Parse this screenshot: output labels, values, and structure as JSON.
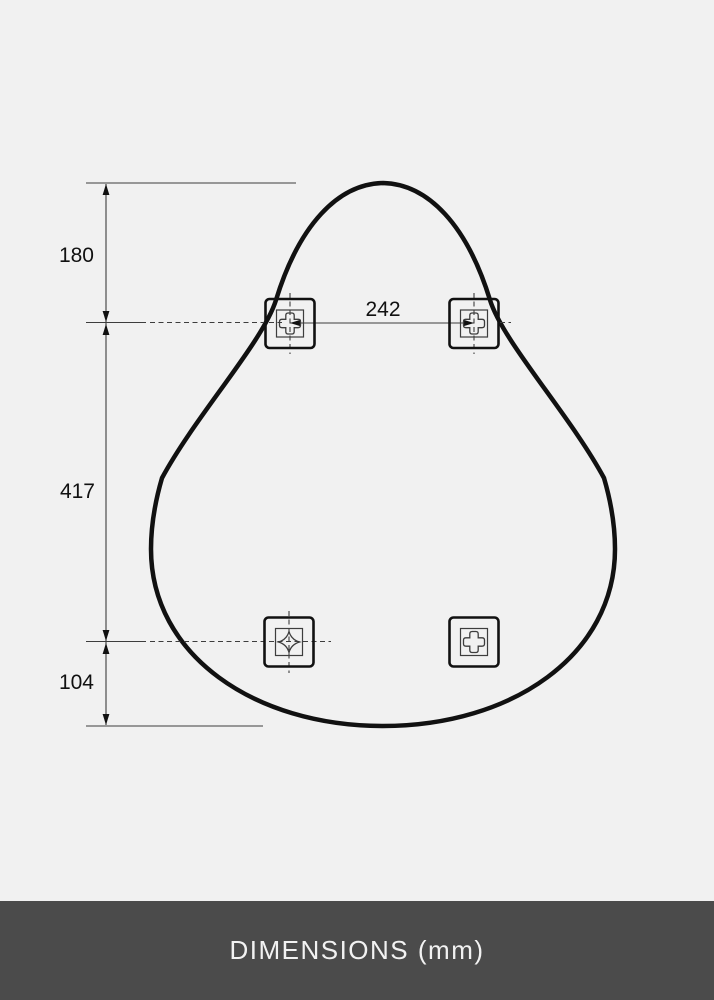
{
  "colors": {
    "bg": "#f1f1f1",
    "ink": "#111111",
    "line": "#3d3d3d",
    "footerBg": "#4b4b4b",
    "footerText": "#f2f2f2"
  },
  "dimensions": {
    "top_offset_mm": "180",
    "middle_span_mm": "417",
    "bottom_offset_mm": "104",
    "bracket_spacing_mm": "242"
  },
  "icons": {
    "bracket": "wall-mount-bracket",
    "screw_slot_clover": "clover-screw-slot",
    "screw_slot_star": "star-screw-slot"
  },
  "footer": {
    "title": "DIMENSIONS (mm)"
  }
}
